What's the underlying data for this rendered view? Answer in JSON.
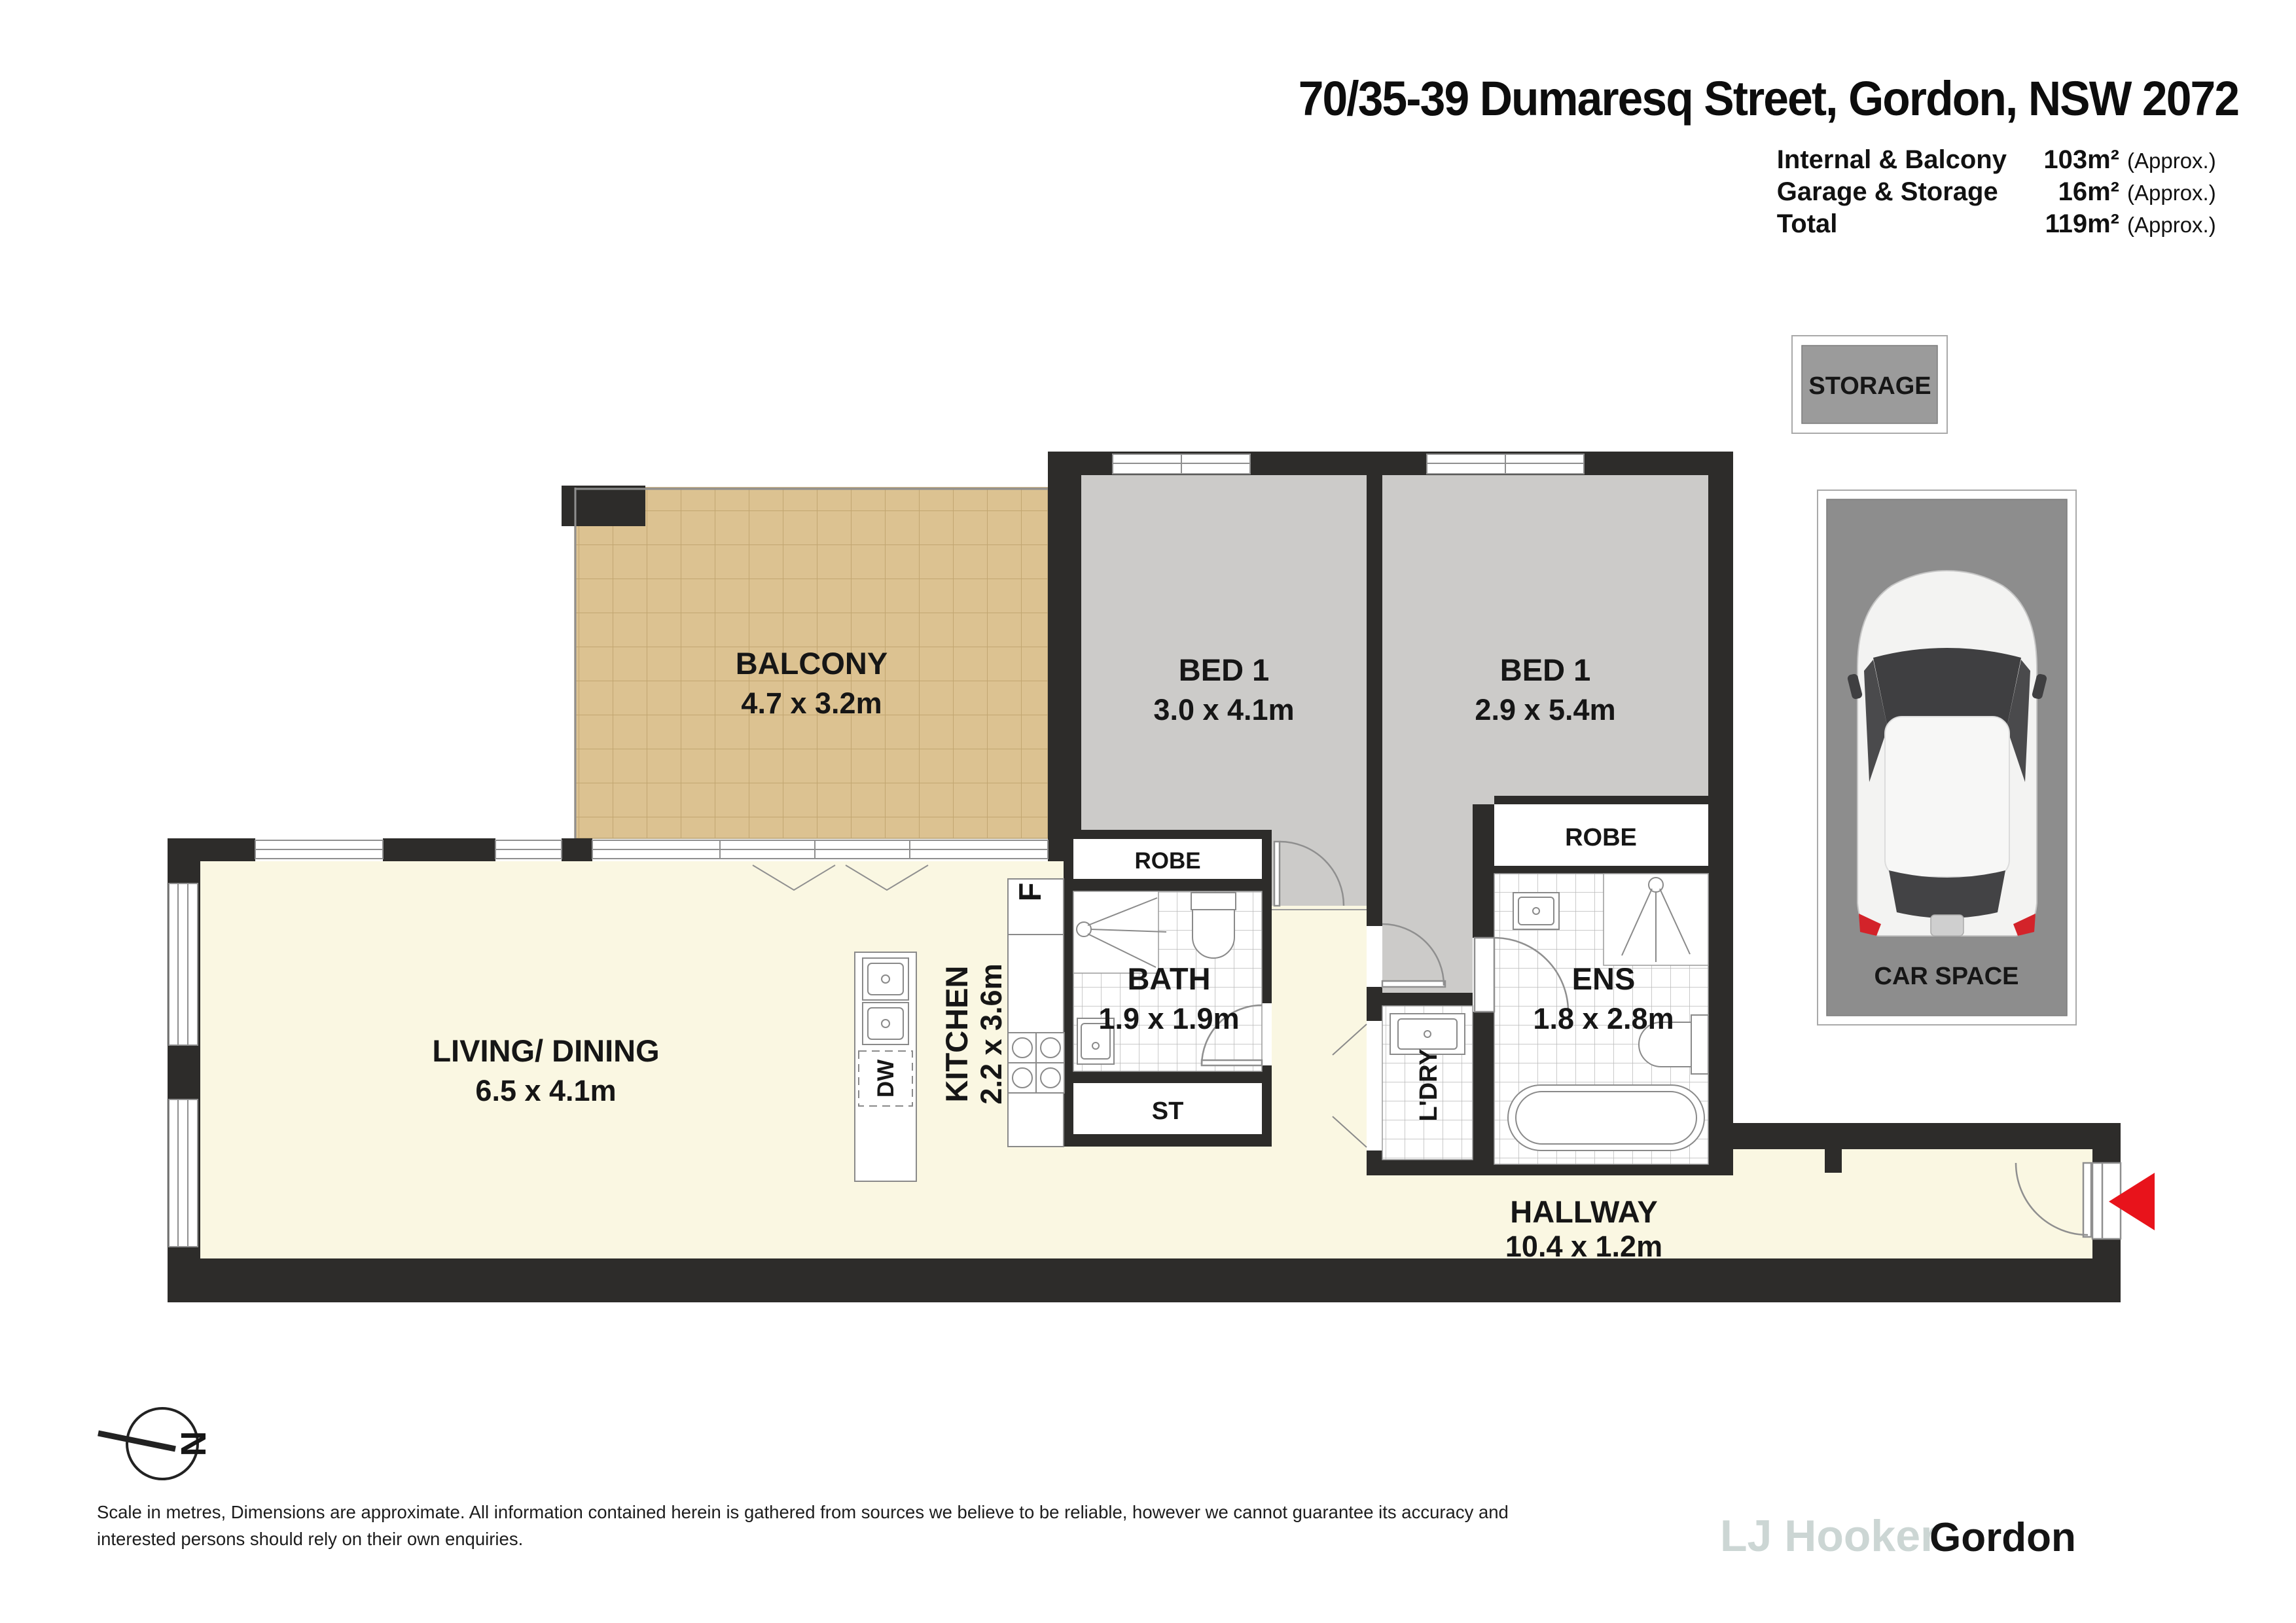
{
  "header": {
    "title": "70/35-39 Dumaresq Street, Gordon, NSW 2072",
    "areas": [
      {
        "label": "Internal & Balcony",
        "value": "103m²",
        "suffix": "(Approx.)"
      },
      {
        "label": "Garage & Storage",
        "value": "16m²",
        "suffix": "(Approx.)"
      },
      {
        "label": "Total",
        "value": "119m²",
        "suffix": "(Approx.)"
      }
    ]
  },
  "plan": {
    "balcony": {
      "name": "BALCONY",
      "dims": "4.7 x 3.2m"
    },
    "bed1": {
      "name": "BED 1",
      "dims": "3.0 x 4.1m"
    },
    "bed2": {
      "name": "BED 1",
      "dims": "2.9 x 5.4m"
    },
    "living": {
      "name": "LIVING/ DINING",
      "dims": "6.5 x 4.1m"
    },
    "kitchen": {
      "name": "KITCHEN",
      "dims": "2.2 x 3.6m"
    },
    "bath": {
      "name": "BATH",
      "dims": "1.9 x 1.9m"
    },
    "ens": {
      "name": "ENS",
      "dims": "1.8 x 2.8m"
    },
    "hallway": {
      "name": "HALLWAY",
      "dims": "10.4 x 1.2m"
    },
    "robe_left": "ROBE",
    "robe_right": "ROBE",
    "st": "ST",
    "ldry": "L'DRY",
    "fridge": "F",
    "dishwasher": "DW"
  },
  "garage": {
    "storage": "STORAGE",
    "car_space": "CAR SPACE"
  },
  "compass": {
    "north": "N"
  },
  "footer": {
    "line1": "Scale in metres, Dimensions are approximate. All information contained herein is gathered from sources we believe to be reliable, however we cannot guarantee its accuracy and",
    "line2": "interested persons should rely on their own enquiries.",
    "brand": "LJ Hooker",
    "office": "Gordon"
  },
  "colors": {
    "wall": "#2d2c2a",
    "bedroom_floor": "#cccbc9",
    "living_floor": "#faf7e2",
    "balcony_tile": "#dcc291",
    "garage_grey": "#8d8d8d",
    "entry_arrow": "#e8131b"
  }
}
